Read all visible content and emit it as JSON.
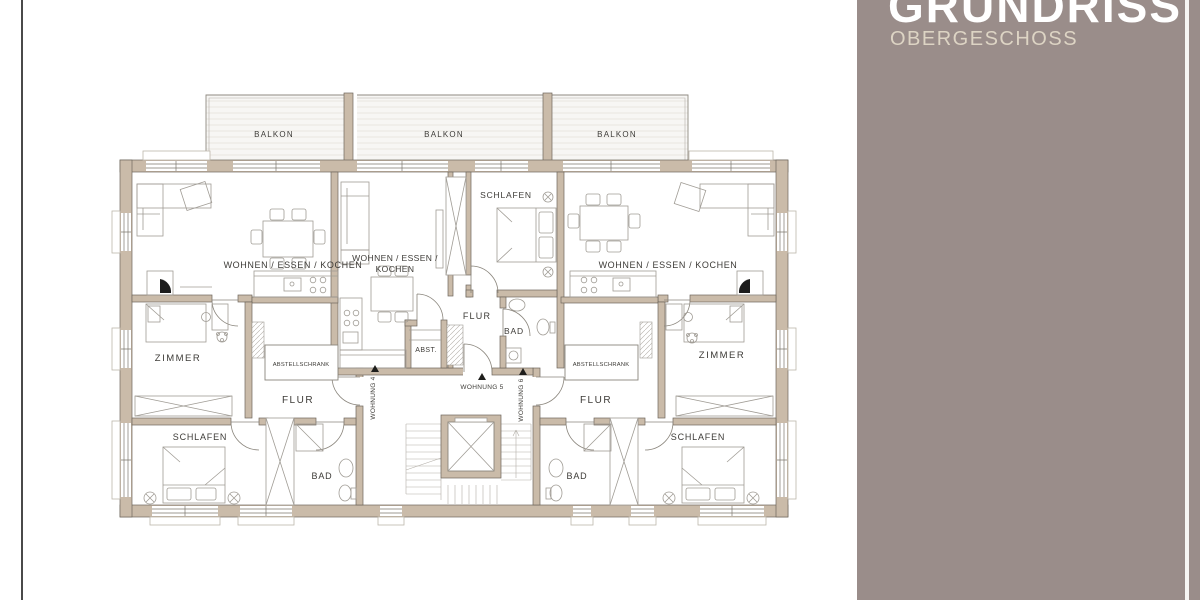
{
  "page": {
    "background": "#ffffff",
    "accent_line_color": "#4a4a4a"
  },
  "sidebar": {
    "title": "GRUNDRISS",
    "subtitle": "OBERGESCHOSS",
    "bg_color": "#9a8d8a",
    "title_color": "#ffffff",
    "subtitle_color": "#ddd4c4",
    "divider_color": "#f7f6f4"
  },
  "floorplan": {
    "colors": {
      "wall_fill": "#cabba9",
      "wall_stroke": "#6e665c",
      "furniture_stroke": "#a09c95",
      "label_color": "#3d3b37"
    },
    "balconies": [
      {
        "label": "BALKON"
      },
      {
        "label": "BALKON"
      },
      {
        "label": "BALKON"
      }
    ],
    "rooms": {
      "wek_left": "WOHNEN / ESSEN / KOCHEN",
      "wek_mid_line1": "WOHNEN / ESSEN /",
      "wek_mid_line2": "KOCHEN",
      "wek_right": "WOHNEN / ESSEN / KOCHEN",
      "schlafen_mid": "SCHLAFEN",
      "zimmer_left": "ZIMMER",
      "zimmer_right": "ZIMMER",
      "flur_left": "FLUR",
      "flur_mid": "FLUR",
      "flur_right": "FLUR",
      "bad_mid": "BAD",
      "bad_left": "BAD",
      "bad_right": "BAD",
      "schlafen_left": "SCHLAFEN",
      "schlafen_right": "SCHLAFEN",
      "abst_mid": "ABST.",
      "abstellschrank_left": "ABSTELLSCHRANK",
      "abstellschrank_right": "ABSTELLSCHRANK"
    },
    "units": {
      "unit4": "WOHNUNG 4",
      "unit5": "WOHNUNG 5",
      "unit6": "WOHNUNG 6"
    }
  }
}
